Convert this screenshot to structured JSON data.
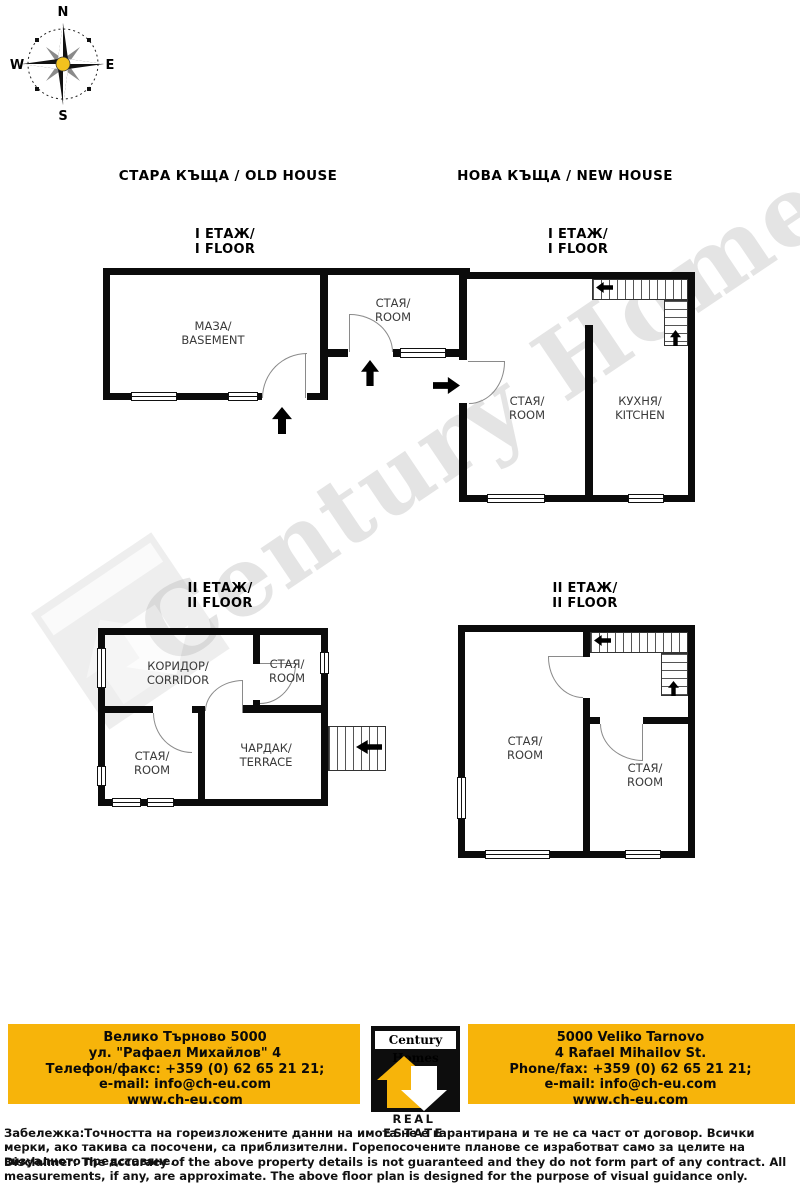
{
  "compass": {
    "n": "N",
    "s": "S",
    "e": "E",
    "w": "W"
  },
  "watermark": {
    "text": "Century Homes"
  },
  "sections": {
    "old_house": {
      "title": "СТАРА КЪЩА / OLD HOUSE",
      "floor1": {
        "label": [
          "I ЕТАЖ/",
          "I FLOOR"
        ],
        "rooms": [
          {
            "bg": "МАЗА/",
            "en": "BASEMENT"
          },
          {
            "bg": "СТАЯ/",
            "en": "ROOM"
          }
        ]
      },
      "floor2": {
        "label": [
          "II ЕТАЖ/",
          "II FLOOR"
        ],
        "rooms": [
          {
            "bg": "КОРИДОР/",
            "en": "CORRIDOR"
          },
          {
            "bg": "СТАЯ/",
            "en": "ROOM"
          },
          {
            "bg": "СТАЯ/",
            "en": "ROOM"
          },
          {
            "bg": "ЧАРДАК/",
            "en": "TERRACE"
          }
        ]
      }
    },
    "new_house": {
      "title": "НОВА КЪЩА / NEW HOUSE",
      "floor1": {
        "label": [
          "I ЕТАЖ/",
          "I FLOOR"
        ],
        "rooms": [
          {
            "bg": "СТАЯ/",
            "en": "ROOM"
          },
          {
            "bg": "КУХНЯ/",
            "en": "KITCHEN"
          }
        ]
      },
      "floor2": {
        "label": [
          "II ЕТАЖ/",
          "II FLOOR"
        ],
        "rooms": [
          {
            "bg": "СТАЯ/",
            "en": "ROOM"
          },
          {
            "bg": "СТАЯ/",
            "en": "ROOM"
          }
        ]
      }
    }
  },
  "footer": {
    "colors": {
      "yellow": "#F7B40A",
      "black": "#0d0d0d"
    },
    "left": {
      "lines": [
        "Велико Търново 5000",
        "ул. \"Рафаел Михайлов\" 4",
        "Телефон/факс: +359 (0) 62 65 21 21;",
        "e-mail: info@ch-eu.com",
        "www.ch-eu.com"
      ]
    },
    "right": {
      "lines": [
        "5000 Veliko Tarnovo",
        "4 Rafael Mihailov St.",
        "Phone/fax: +359 (0) 62 65 21 21;",
        "e-mail: info@ch-eu.com",
        "www.ch-eu.com"
      ]
    },
    "logo": {
      "name": "Century Homes",
      "tagline": "REAL ESTATE"
    }
  },
  "disclaimer": {
    "bg": "Забележка:Точността на гореизложените данни на имота не е гарантирана и те не са част от договор. Всички мерки, ако такива са посочени, са приблизителни. Горепосочените планове се изработват само за целите на визуалното представяне.",
    "en": "Disclaimer: The accuracy of the above property details is not guaranteed and they do not form part of any contract. All measurements, if any, are approximate. The above floor plan is designed for the purpose of visual guidance only."
  }
}
